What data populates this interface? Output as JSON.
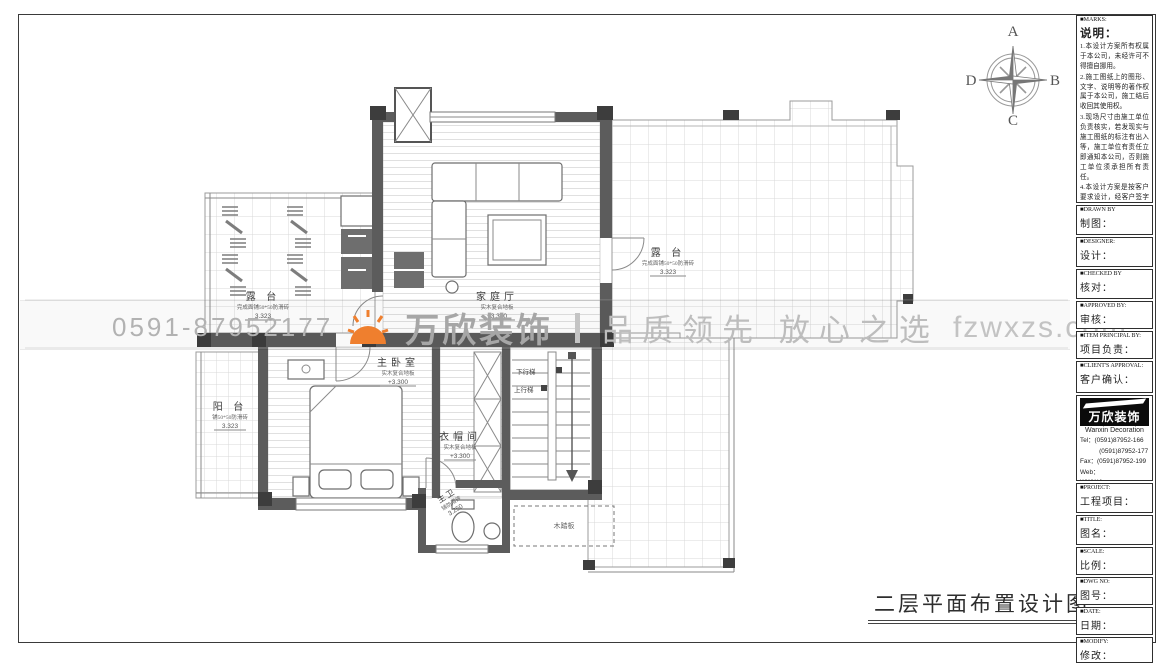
{
  "compass": {
    "top": "A",
    "right": "B",
    "bottom": "C",
    "left": "D"
  },
  "watermark": {
    "phone": "0591-87952177",
    "brand": "万欣装饰",
    "slogan": "品质领先 放心之选",
    "website": "fzwxzs.com",
    "accent_color": "#ef7f2e",
    "text_color": "#b2b2b2"
  },
  "drawing_title": "二层平面布置设计图",
  "rooms": {
    "terrace_tl": {
      "name": "露 台",
      "sub": "完成面铺50*50防滑砖",
      "elev": "3.323"
    },
    "terrace_r": {
      "name": "露 台",
      "sub": "完成面铺50*50防滑砖",
      "elev": "3.323"
    },
    "balcony": {
      "name": "阳 台",
      "sub": "铺50*50防滑砖",
      "elev": "3.323"
    },
    "family": {
      "name": "家庭厅",
      "sub": "实木复合地板",
      "elev": "+3.300"
    },
    "master": {
      "name": "主卧室",
      "sub": "实木复合地板",
      "elev": "+3.300"
    },
    "closet": {
      "name": "衣帽间",
      "sub": "实木复合地板",
      "elev": "+3.300"
    },
    "bath": {
      "name": "主卫",
      "sub": "铺防滑砖",
      "elev": "3.250"
    },
    "platform": {
      "name": "木踏板"
    },
    "stair_down": "下行梯",
    "stair_up": "上行梯"
  },
  "titleblock": {
    "marks": {
      "en": "■MARKS:",
      "title": "说明：",
      "notes": [
        "1.本设计方案所有权属于本公司，未经许可不得擅自挪用。",
        "2.施工图纸上的图形、文字、说明等的著作权属于本公司，施工结后收回其使用权。",
        "3.现场尺寸由施工单位负责核实，若发现实与施工图纸的标注有出入等，施工单位有责任立即通知本公司，否则施工单位须承担所有责任。",
        "4.本设计方案是按客户要求设计，经客户签字即视为同意认可，不得随意更改。"
      ]
    },
    "fields": [
      {
        "en": "■DRAWN BY",
        "zh": "制图："
      },
      {
        "en": "■DESIGNER:",
        "zh": "设计："
      },
      {
        "en": "■CHECKED BY",
        "zh": "核对："
      },
      {
        "en": "■APPROVED BY:",
        "zh": "审核："
      },
      {
        "en": "■ITEM PRINCIPAL BY:",
        "zh": "项目负责："
      },
      {
        "en": "■CLIENT'S APPROVAL:",
        "zh": "客户确认："
      }
    ],
    "logo": {
      "brand_zh": "万欣装饰",
      "brand_en": "Wanxin Decoration",
      "lines": [
        "Tel：(0591)87952-166",
        "　　　(0591)87952-177",
        "Fax：(0591)87952-199",
        "Web：WWW.fzwxzs.com"
      ]
    },
    "fields2": [
      {
        "en": "■PROJECT:",
        "zh": "工程项目："
      },
      {
        "en": "■TITLE:",
        "zh": "图名："
      },
      {
        "en": "■SCALE:",
        "zh": "比例："
      },
      {
        "en": "■DWG NO:",
        "zh": "图号："
      },
      {
        "en": "■DATE:",
        "zh": "日期："
      },
      {
        "en": "■MODIFY:",
        "zh": "修改："
      }
    ]
  }
}
